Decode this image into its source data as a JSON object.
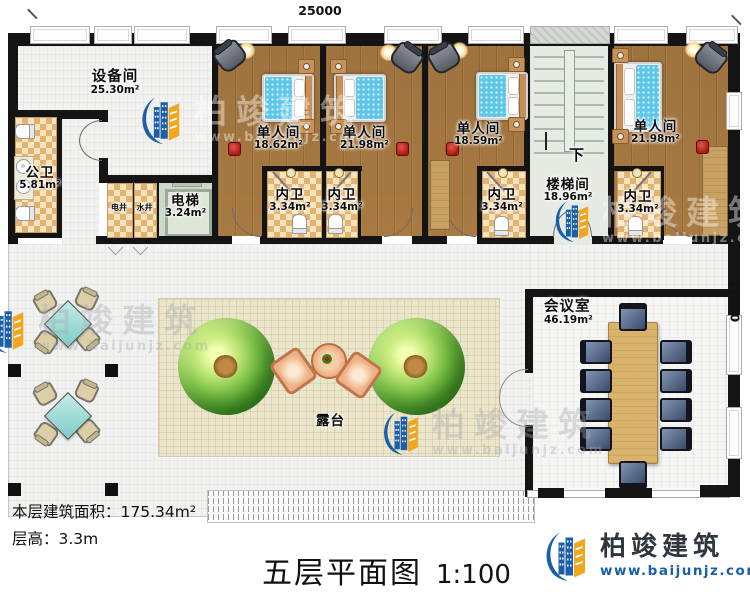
{
  "dimensions": {
    "top": "25000",
    "right": "17500"
  },
  "rooms": {
    "equipment": {
      "name": "设备间",
      "area": "25.30m²"
    },
    "public_wc": {
      "name": "公卫",
      "area": "5.81m²"
    },
    "electric_shaft": {
      "name": "电井"
    },
    "water_shaft": {
      "name": "水井"
    },
    "elevator": {
      "name": "电梯",
      "area": "3.24m²"
    },
    "single1": {
      "name": "单人间",
      "area": "18.62m²"
    },
    "single2": {
      "name": "单人间",
      "area": "21.98m²"
    },
    "single3": {
      "name": "单人间",
      "area": "18.59m²"
    },
    "single4": {
      "name": "单人间",
      "area": "21.98m²"
    },
    "ensuite1": {
      "name": "内卫",
      "area": "3.34m²"
    },
    "ensuite2": {
      "name": "内卫",
      "area": "3.34m²"
    },
    "ensuite3": {
      "name": "内卫",
      "area": "3.34m²"
    },
    "ensuite4": {
      "name": "内卫",
      "area": "3.34m²"
    },
    "stairwell": {
      "name": "楼梯间",
      "area": "18.96m²",
      "direction": "下"
    },
    "meeting": {
      "name": "会议室",
      "area": "46.19m²"
    },
    "terrace": {
      "name": "露台"
    }
  },
  "annotations": {
    "floor_area_label": "本层建筑面积：",
    "floor_area_value": "175.34m²",
    "floor_height_label": "层高：",
    "floor_height_value": "3.3m"
  },
  "title": {
    "text": "五层平面图",
    "scale": "1:100"
  },
  "brand": {
    "name": "柏竣建筑",
    "url": "www.baijunjz.com"
  },
  "watermark": {
    "name": "柏竣建筑",
    "url": "www.baijunjz.com"
  },
  "colors": {
    "wall": "#141414",
    "wood_floor": "#a87a42",
    "checker_tile": "#e2b271",
    "bed_blue": "#5ec7e8",
    "terrace_beige": "#ebe6cb",
    "tree_green": "#4d9c2c",
    "meeting_table_wood": "#d9b26b",
    "meeting_chair": "#3c4a68",
    "logo_blue": "#1a5fa8",
    "logo_orange": "#f2a51e"
  }
}
